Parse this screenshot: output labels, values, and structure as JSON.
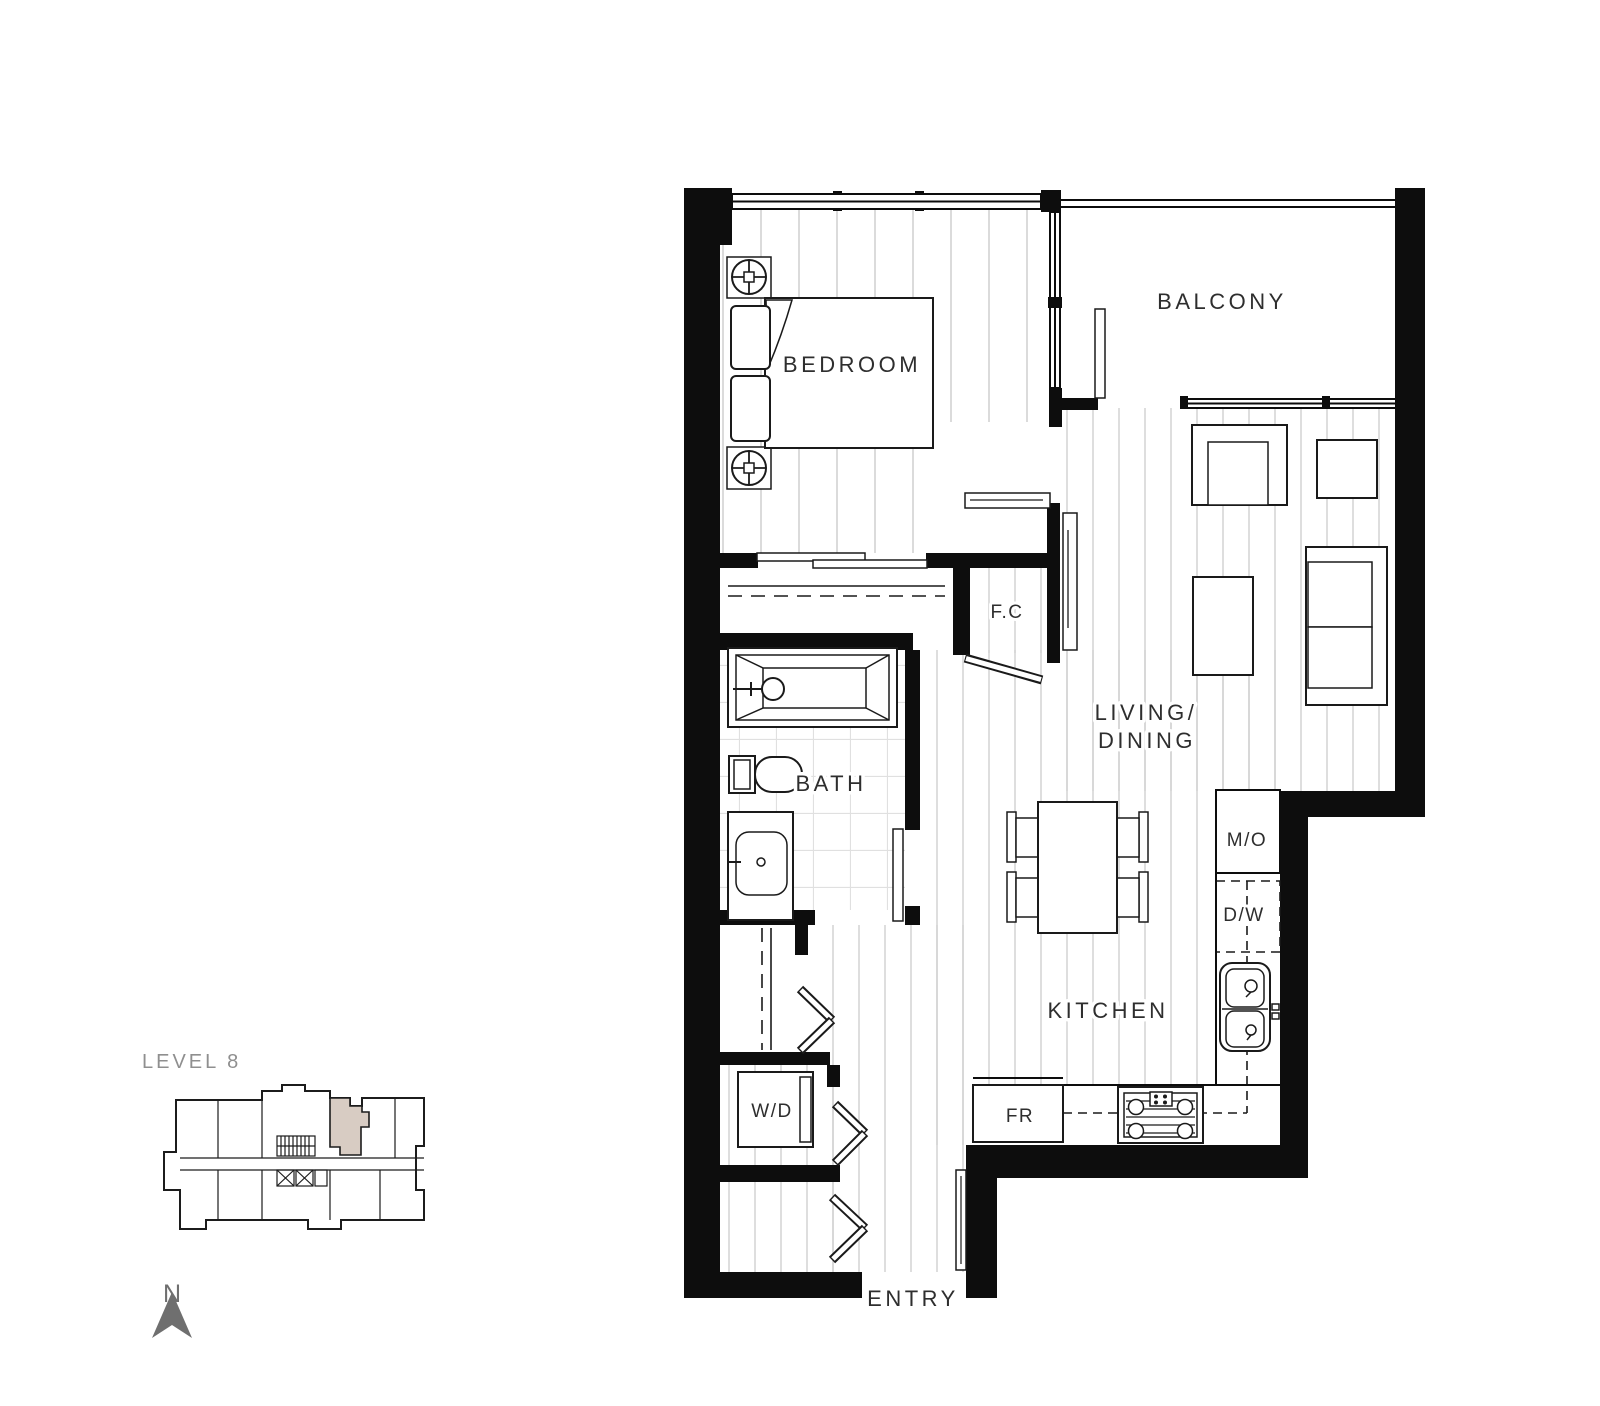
{
  "plan": {
    "labels": {
      "bedroom": "BEDROOM",
      "balcony": "BALCONY",
      "fc": "F.C",
      "living_line1": "LIVING/",
      "living_line2": "DINING",
      "bath": "BATH",
      "kitchen": "KITCHEN",
      "microwave": "M/O",
      "dishwasher": "D/W",
      "washer_dryer": "W/D",
      "fridge": "FR",
      "entry": "ENTRY"
    },
    "fixtures": [
      "bed",
      "nightstand-lamp",
      "bathtub",
      "toilet",
      "vanity-sink",
      "armchair",
      "side-table",
      "coffee-table",
      "sofa",
      "dining-table",
      "dining-chair",
      "kitchen-sink",
      "gas-cooktop",
      "fridge",
      "washer-dryer",
      "bifold-door",
      "swing-door",
      "sliding-panel"
    ],
    "colors": {
      "walls": "#0d0d0d",
      "floor_lines": "#cfcfcf",
      "tile_lines": "#e0e0e0",
      "text": "#2e2e2e",
      "muted_text": "#8f8f8f",
      "compass": "#6f6f6f",
      "background": "#ffffff"
    }
  },
  "key_plan": {
    "title": "LEVEL 8",
    "compass_label": "N",
    "highlight_color": "#d8ccc3"
  }
}
